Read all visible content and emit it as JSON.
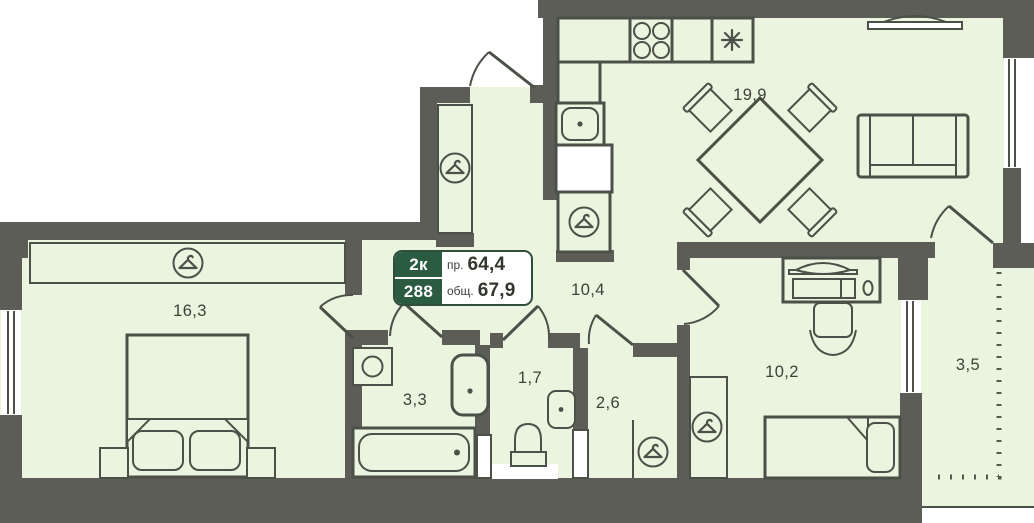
{
  "card": {
    "type": "2к",
    "number": "288",
    "living_label": "пр.",
    "living_value": "64,4",
    "total_label": "общ.",
    "total_value": "67,9"
  },
  "rooms": [
    {
      "name": "kitchen-living-room",
      "area": "19,9"
    },
    {
      "name": "bedroom",
      "area": "16,3"
    },
    {
      "name": "hallway",
      "area": "10,4"
    },
    {
      "name": "bathroom",
      "area": "3,3"
    },
    {
      "name": "wc",
      "area": "1,7"
    },
    {
      "name": "storage",
      "area": "2,6"
    },
    {
      "name": "bedroom-2",
      "area": "10,2"
    },
    {
      "name": "balcony",
      "area": "3,5"
    }
  ],
  "icons": {
    "wardrobe": "hanger-in-circle",
    "stove": "four-burner-cooktop",
    "extractor": "asterisk",
    "sink": "basin-with-dot"
  },
  "colors": {
    "wall": "#5d5d58",
    "floor": "#eaf4de",
    "line": "#4b5148",
    "card_green": "#2b5c41",
    "card_border": "#314d3c",
    "text": "#3c413a",
    "background": "#ffffff"
  }
}
